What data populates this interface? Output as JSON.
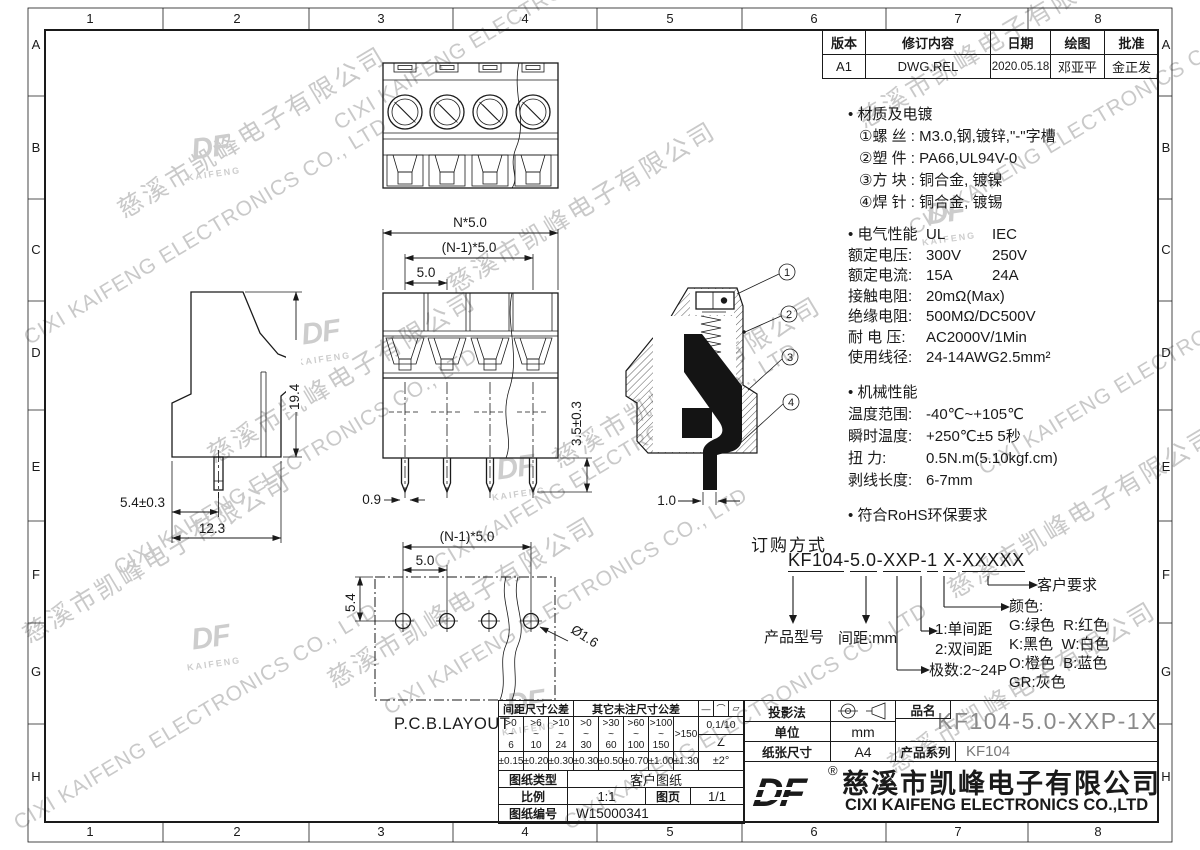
{
  "frame": {
    "cols": [
      "1",
      "2",
      "3",
      "4",
      "5",
      "6",
      "7",
      "8"
    ],
    "rows": [
      "A",
      "B",
      "C",
      "D",
      "E",
      "F",
      "G",
      "H"
    ]
  },
  "revision": {
    "headers": [
      "版本",
      "修订内容",
      "日期",
      "绘图",
      "批准"
    ],
    "row": [
      "A1",
      "DWG.REL",
      "2020.05.18",
      "邓亚平",
      "金正发"
    ]
  },
  "notes": {
    "material": {
      "bullet": "•",
      "title": "材质及电镀",
      "items": [
        "①螺 丝 : M3.0,钢,镀锌,\"-\"字槽",
        "②塑 件 : PA66,UL94V-0",
        "③方 块 : 铜合金, 镀镍",
        "④焊 针 : 铜合金, 镀锡"
      ]
    },
    "electrical": {
      "bullet": "•",
      "title": "电气性能",
      "col1": "UL",
      "col2": "IEC",
      "rows": [
        {
          "label": "额定电压:",
          "ul": "300V",
          "iec": "250V"
        },
        {
          "label": "额定电流:",
          "ul": "15A",
          "iec": "24A"
        },
        {
          "label": "接触电阻:",
          "ul": "20mΩ(Max)",
          "iec": ""
        },
        {
          "label": "绝缘电阻:",
          "ul": "500MΩ/DC500V",
          "iec": ""
        },
        {
          "label": "耐 电 压:",
          "ul": "AC2000V/1Min",
          "iec": ""
        },
        {
          "label": "使用线径:",
          "ul": "24-14AWG",
          "iec": "2.5mm²"
        }
      ]
    },
    "mechanical": {
      "bullet": "•",
      "title": "机械性能",
      "rows": [
        {
          "label": "温度范围:",
          "value": "-40℃~+105℃"
        },
        {
          "label": "瞬时温度:",
          "value": "+250℃±5  5秒"
        },
        {
          "label": "扭    力:",
          "value": "0.5N.m(5.10kgf.cm)"
        },
        {
          "label": "剥线长度:",
          "value": "6-7mm"
        }
      ]
    },
    "rohs": {
      "bullet": "•",
      "text": "符合RoHS环保要求"
    }
  },
  "ordering": {
    "title": "订购方式",
    "segments": [
      "KF104",
      "5.0",
      "XXP",
      "1",
      "X",
      "XXXXX"
    ],
    "separators": [
      "-",
      "-",
      "-",
      " ",
      "-"
    ],
    "labels": {
      "customer": "客户要求",
      "color_title": "颜色:",
      "color_rows": [
        "G:绿色  R:红色",
        "K:黑色  W:白色",
        "O:橙色  B:蓝色",
        "GR:灰色"
      ],
      "pitch_type_1": "1:单间距",
      "pitch_type_2": "2:双间距",
      "poles": "极数:2~24P",
      "model": "产品型号",
      "pitch": "间距:mm"
    }
  },
  "views": {
    "dims": {
      "front_total": "N*5.0",
      "front_span": "(N-1)*5.0",
      "front_pitch": "5.0",
      "pin_w": "0.9",
      "pin_len": "3.5±0.3",
      "side_h": "19.4",
      "side_off": "5.4±0.3",
      "side_w": "12.3",
      "sec_pin": "1.0",
      "pcb_span": "(N-1)*5.0",
      "pcb_pitch": "5.0",
      "pcb_off": "5.4",
      "pcb_hole": "Ø1.6",
      "pcb_label": "P.C.B.LAYOUT"
    },
    "callouts": [
      "1",
      "2",
      "3",
      "4"
    ]
  },
  "tol_table": {
    "h1": "间距尺寸公差",
    "h2": "其它未注尺寸公差",
    "sym": [
      "—",
      "⌒",
      "▱"
    ],
    "ranges": [
      ">0\n~\n6",
      ">6\n~\n10",
      ">10\n~\n24",
      ">0\n~\n30",
      ">30\n~\n60",
      ">60\n~\n100",
      ">100\n~\n150",
      ">150"
    ],
    "tols": [
      "±0.15",
      "±0.20",
      "±0.30",
      "±0.30",
      "±0.50",
      "±0.70",
      "±1.00",
      "±1.30"
    ],
    "flat": "0.1/10",
    "angle_sym": "∠",
    "angle_tol": "±2°",
    "rows": {
      "type_label": "图纸类型",
      "type_value": "客户图纸",
      "scale_label": "比例",
      "scale_value": "1:1",
      "page_label": "图页",
      "page_value": "1/1",
      "no_label": "图纸编号",
      "no_value": "W15000341"
    }
  },
  "title_block": {
    "projection_label": "投影法",
    "unit_label": "单位",
    "unit_value": "mm",
    "paper_label": "纸张尺寸",
    "paper_value": "A4",
    "name_label": "品名",
    "name_value": "KF104-5.0-XXP-1X",
    "series_label": "产品系列",
    "series_value": "KF104",
    "logo_text": "DF",
    "reg": "®",
    "company_cn": "慈溪市凯峰电子有限公司",
    "company_en": "CIXI KAIFENG ELECTRONICS CO.,LTD"
  },
  "watermark": {
    "cn": "慈溪市凯峰电子有限公司",
    "en": "CIXI KAIFENG ELECTRONICS CO., LTD",
    "logo": "DF",
    "logo_sub": "KAIFENG"
  }
}
